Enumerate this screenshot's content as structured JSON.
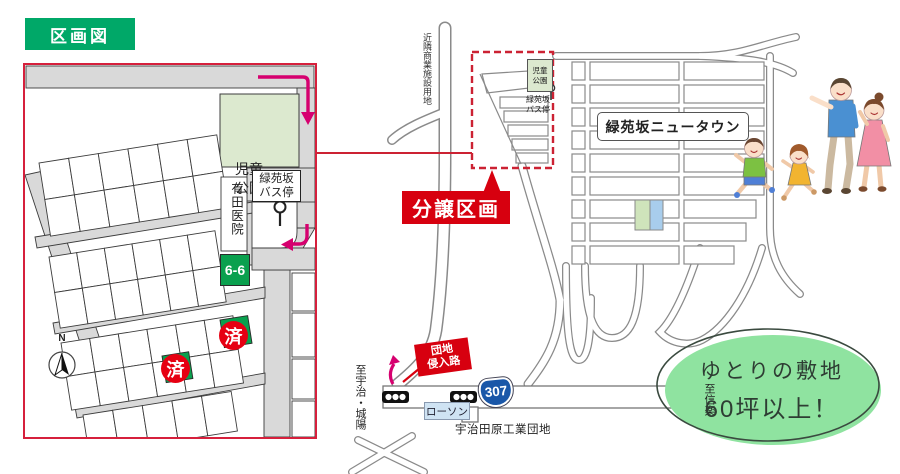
{
  "badge": {
    "label": "区画図"
  },
  "lot_map": {
    "park_label": "児童\n公園",
    "bus_stop_label": "緑苑坂\nバス停",
    "clinic_label": "有田医院",
    "lot_number": "6-6",
    "sold_badges": [
      "済",
      "済"
    ],
    "compass_label": "N"
  },
  "area_map": {
    "commercial_site_label": "近隣商業施設用地",
    "park_label": "児童\n公園",
    "bus_stop_label": "緑苑坂\nバス停",
    "sale_area_label": "分譲区画",
    "newtown_label": "緑苑坂ニュータウン",
    "entrance_label": "団地\n侵入路",
    "route_number": "307",
    "to_west_label": "至宇治・城陽",
    "to_east_label": "至信楽",
    "store_label": "ローソン",
    "industrial_label": "宇治田原工業団地"
  },
  "callout": {
    "line1": "ゆとりの敷地",
    "line2": "60坪以上！"
  },
  "colors": {
    "badge_green": "#00a868",
    "map_border_red": "#d6203c",
    "accent_red": "#d7000f",
    "sold_red": "#e60012",
    "lot_green": "#0aa04e",
    "park_green": "#dce9cf",
    "arrow_magenta": "#d6006f",
    "route_blue": "#1a57a8",
    "oval_green": "#8fe3a0",
    "lawson_blue": "#cfe3f3"
  }
}
